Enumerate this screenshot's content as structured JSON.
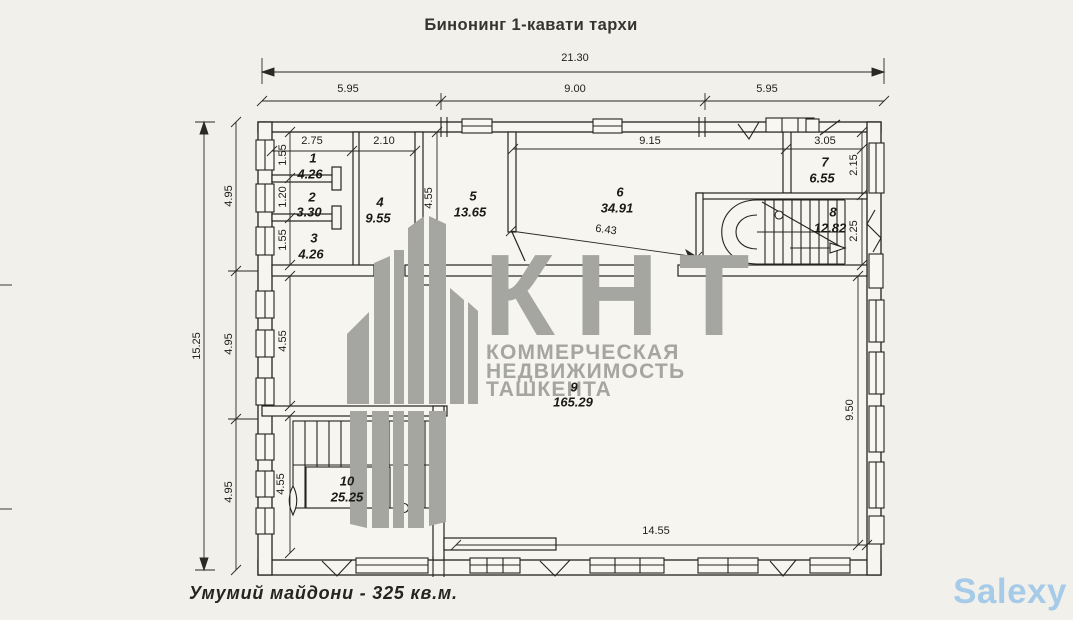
{
  "title": "Бинонинг 1-кавати тархи",
  "footer": {
    "total_area": "Умумий майдони - 325 кв.м."
  },
  "brand": "Salexy",
  "watermark": {
    "logo": "КНТ",
    "line1": "КОММЕРЧЕСКАЯ",
    "line2": "НЕДВИЖИМОСТЬ",
    "line3": "ТАШКЕНТА"
  },
  "colors": {
    "paper": "#f1f0ea",
    "ink": "#24231f",
    "watermark_gray": "#a5a5a2",
    "brand_blue": "#a6cbe9"
  },
  "plan": {
    "overall": {
      "width": "21.30",
      "height": "15.25"
    },
    "top_segments": [
      "5.95",
      "9.00",
      "5.95"
    ],
    "left_segments": [
      "4.95",
      "4.95",
      "4.95"
    ],
    "rooms": [
      {
        "num": "1",
        "area": "4.26"
      },
      {
        "num": "2",
        "area": "3.30"
      },
      {
        "num": "3",
        "area": "4.26"
      },
      {
        "num": "4",
        "area": "9.55"
      },
      {
        "num": "5",
        "area": "13.65"
      },
      {
        "num": "6",
        "area": "34.91"
      },
      {
        "num": "7",
        "area": "6.55"
      },
      {
        "num": "8",
        "area": "12.82"
      },
      {
        "num": "9",
        "area": "165.29"
      },
      {
        "num": "10",
        "area": "25.25"
      }
    ],
    "dims": {
      "rooms123_width": "2.75",
      "room4_width": "2.10",
      "room1_h": "1.55",
      "room2_h": "1.20",
      "room3_h": "1.55",
      "room5_h": "4.55",
      "room6_w": "9.15",
      "room7_w": "3.05",
      "room7_h": "2.15",
      "room8_h": "2.25",
      "diag": "6.43",
      "hall_left_h": "4.55",
      "stair_h": "4.55",
      "hall_bottom_w": "14.55",
      "hall_right_h": "9.50"
    }
  }
}
